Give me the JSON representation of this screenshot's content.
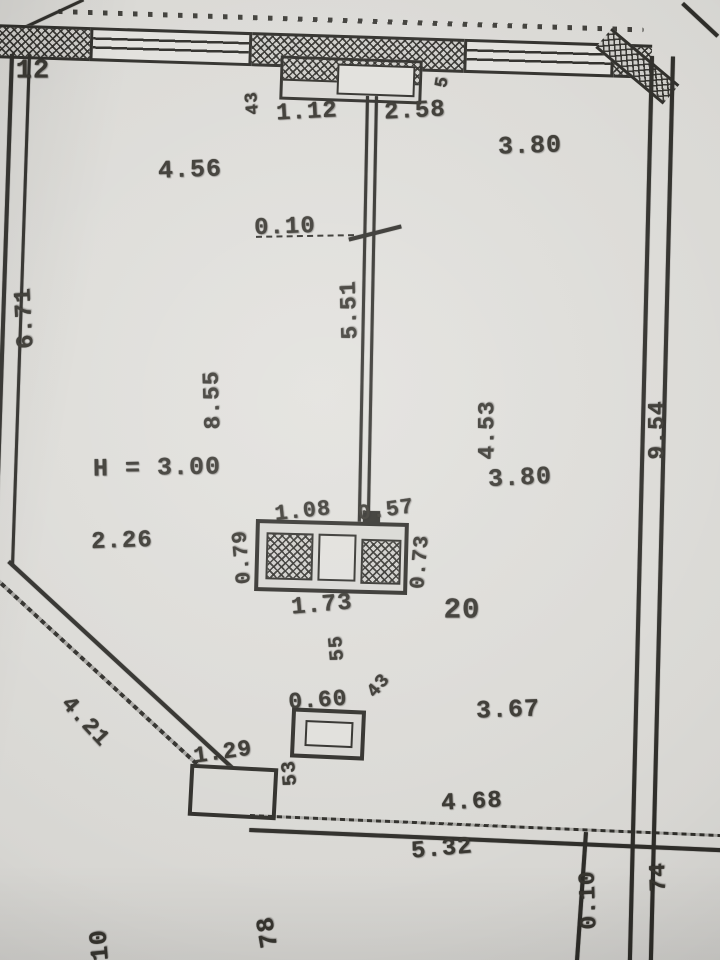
{
  "plan": {
    "room_number": "20",
    "ceiling_height": "H = 3.00"
  },
  "labels": {
    "marker_12": "12",
    "niche_width_left": "1.12",
    "niche_width_right": "2.58",
    "niche_side_left": "43",
    "niche_side_right": "5",
    "room_top_width": "4.56",
    "room_topright_width": "3.80",
    "offset_top": "0.10",
    "partition_length": "5.51",
    "left_wall": "6.71",
    "interior_length": "8.55",
    "dim_2_26": "2.26",
    "room_right_depth": "4.53",
    "room_right_width": "3.80",
    "right_wall": "9.54",
    "fixture_left_width": "1.08",
    "fixture_right_width": "0.57",
    "fixture_left_depth": "0.79",
    "fixture_right_depth": "0.73",
    "fixture_width": "1.73",
    "dim_55": "55",
    "vent_width": "0.60",
    "vent_side": "43",
    "dim_3_67": "3.67",
    "step_width": "1.29",
    "diagonal_wall": "4.21",
    "step_side": "53",
    "bottom_above": "4.68",
    "bottom_below": "5.32",
    "bottom_offset": "0.10",
    "dim_74": "74",
    "cut_left": "10",
    "cut_mid": "78"
  },
  "colors": {
    "ink": "#2b2a26",
    "paper": "#dad9d5"
  }
}
